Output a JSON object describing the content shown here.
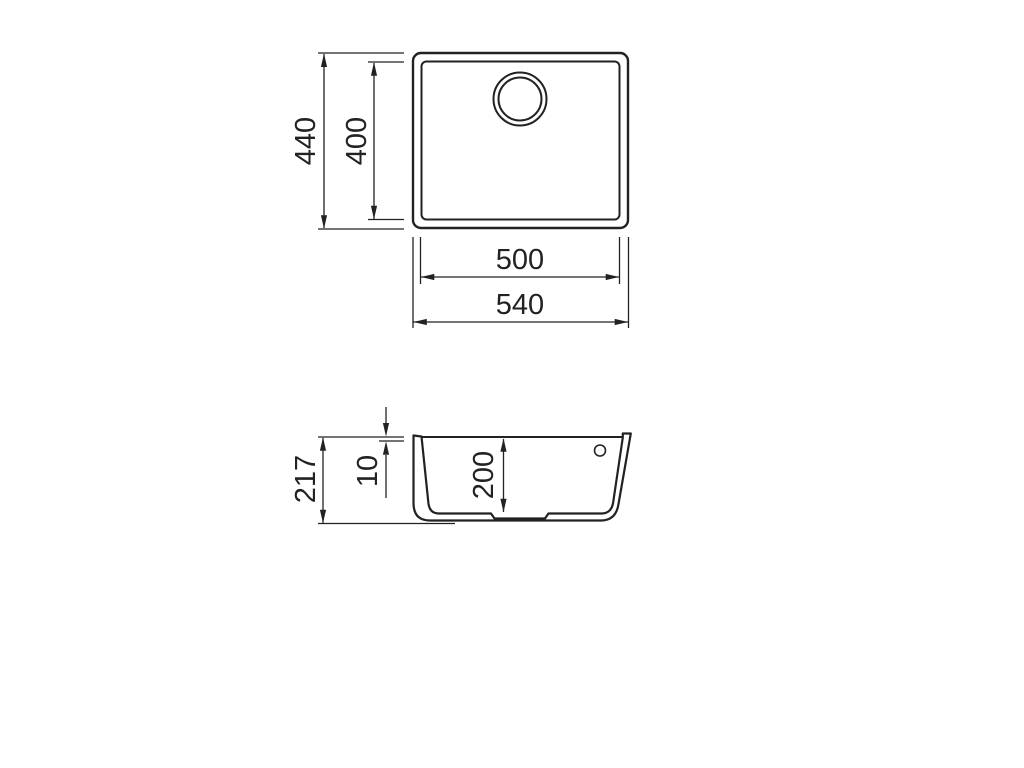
{
  "colors": {
    "line": "#222222",
    "background": "#ffffff"
  },
  "top_view": {
    "outer_height_label": "440",
    "inner_height_label": "400",
    "inner_width_label": "500",
    "outer_width_label": "540"
  },
  "side_view": {
    "total_height_label": "217",
    "rim_thickness_label": "10",
    "bowl_depth_label": "200"
  }
}
